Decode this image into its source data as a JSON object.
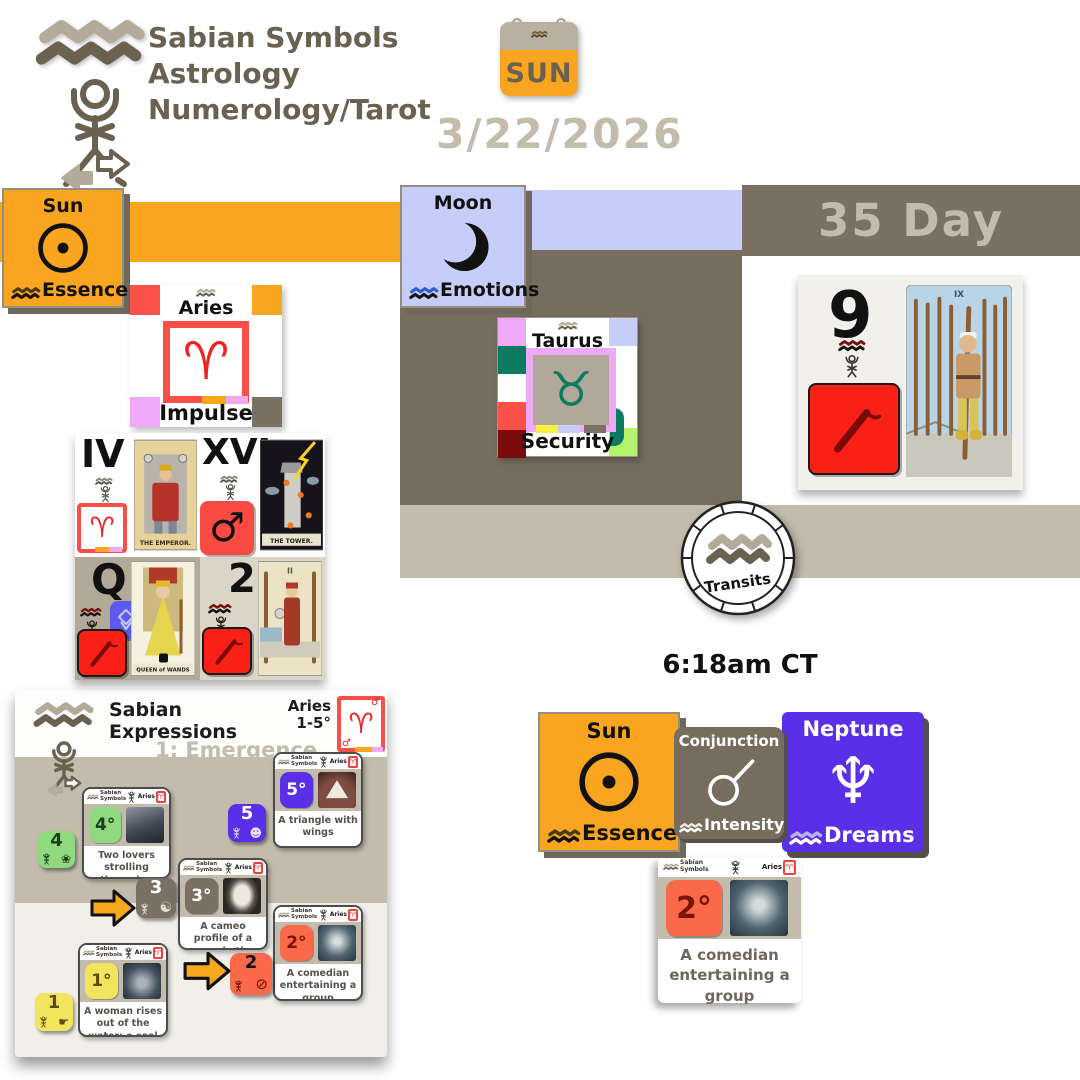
{
  "brand": {
    "line1": "Sabian Symbols",
    "line2": "Astrology",
    "line3": "Numerology/Tarot"
  },
  "calendar": {
    "weekday": "SUN"
  },
  "date_label": "3/22/2026",
  "day_banner": "35 Day",
  "time_label": "6:18am CT",
  "numerology_number": "9",
  "transits_label": "Transits",
  "planets": {
    "sun": {
      "title": "Sun",
      "keyword": "Essence"
    },
    "moon": {
      "title": "Moon",
      "keyword": "Emotions"
    },
    "neptune": {
      "title": "Neptune",
      "keyword": "Dreams"
    }
  },
  "aspect": {
    "title": "Conjunction",
    "keyword": "Intensity"
  },
  "signs": {
    "aries": {
      "title": "Aries",
      "keyword": "Impulse"
    },
    "taurus": {
      "title": "Taurus",
      "keyword": "Security"
    }
  },
  "tarot": {
    "emperor": {
      "numeral": "IV",
      "label": "THE EMPEROR."
    },
    "tower": {
      "numeral": "XVI",
      "label": "THE TOWER."
    },
    "queen": {
      "numeral": "Q",
      "label": "QUEEN of WANDS"
    },
    "two": {
      "numeral": "2",
      "label": "II"
    },
    "nine": {
      "label": "IX"
    }
  },
  "expressions": {
    "brand1": "Sabian",
    "brand2": "Expressions",
    "subtitle": "1: Emergence",
    "sign": "Aries",
    "range": "1-5°",
    "mini": {
      "brand1": "Sabian",
      "brand2": "Symbols",
      "sign": "Aries"
    },
    "degrees": [
      {
        "n": "1",
        "deg": "1°",
        "text": "A woman rises out of the water; a seal rises and embraces her"
      },
      {
        "n": "2",
        "deg": "2°",
        "text": "A comedian entertaining a group"
      },
      {
        "n": "3",
        "deg": "3°",
        "text": "A cameo profile of a man, in the outline of his country"
      },
      {
        "n": "4",
        "deg": "4°",
        "text": "Two lovers strolling through a secluded walk"
      },
      {
        "n": "5",
        "deg": "5°",
        "text": "A triangle with wings"
      }
    ]
  },
  "detail": {
    "deg": "2°",
    "text": "A comedian entertaining a group"
  },
  "icons": {
    "aries_glyph": "♈",
    "taurus_glyph": "♉",
    "mars_glyph": "♂",
    "neptune_glyph": "♆",
    "tile1": "☛",
    "tile2": "⊘",
    "tile3": "☯",
    "tile4": "❀",
    "tile5": "☻"
  },
  "colors": {
    "orange": "#F9A51F",
    "periwinkle": "#C7CDF9",
    "olive": "#776D5F",
    "tan": "#C3BAAB",
    "brand_brown": "#6B6151",
    "purple": "#5B2EE8",
    "red": "#FA4B42",
    "bright_red": "#FB2015",
    "teal": "#0D7A62",
    "violet": "#EEAAF8",
    "green": "#8FD97F",
    "yellow": "#F2E45C",
    "orange_red": "#F9694A",
    "dark_red": "#7A0A0C",
    "light_green": "#B4F46C"
  }
}
